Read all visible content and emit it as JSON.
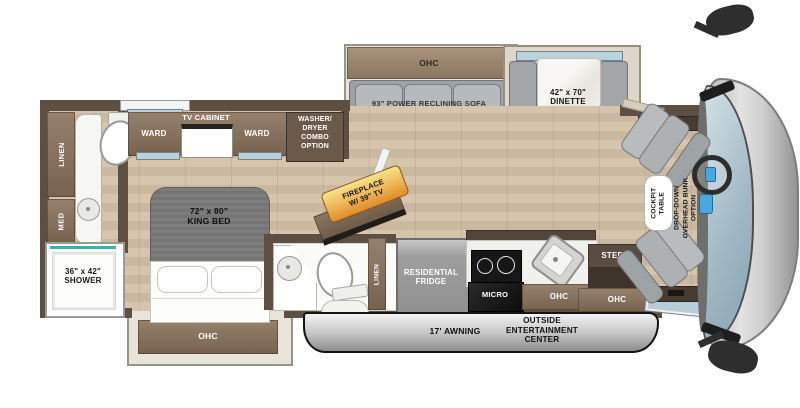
{
  "plan_name": "Class A motorhome floorplan",
  "colors": {
    "wall_brown": "#5d4f42",
    "cabinet_brown": "#86715c",
    "floor_tan": "#d2c0a8",
    "furniture_gray": "#aaadaf",
    "accent_teal": "#35b3ab",
    "fireplace_label_yellow": "#f5d469",
    "fireplace_label_orange": "#e18d2a",
    "windshield_blue": "#a9c0cc",
    "awning_gray": "#c6c6c6"
  },
  "rear_bath": {
    "linen": "LINEN",
    "med": "MED",
    "shower": "36\" x 42\"\nSHOWER"
  },
  "bedroom": {
    "ward_left": "WARD",
    "tv_cabinet": "TV CABINET",
    "ward_right": "WARD",
    "washer_dryer": "WASHER/\nDRYER\nCOMBO\nOPTION",
    "king_bed": "72\" x 80\"\nKING BED",
    "ohc": "OHC"
  },
  "living": {
    "ohc": "OHC",
    "sofa": "93\" POWER RECLINING SOFA",
    "dinette": "42\" x 70\"\nDINETTE",
    "fireplace": "FIREPLACE\nW/ 39\" TV"
  },
  "mid_bath": {
    "med": "MED",
    "linen": "LINEN"
  },
  "kitchen": {
    "fridge": "RESIDENTIAL\nFRIDGE",
    "micro": "MICRO",
    "ohc": "OHC"
  },
  "entry": {
    "steps": "STEPS",
    "ohc": "OHC"
  },
  "exterior": {
    "awning": "17' AWNING",
    "entertainment": "OUTSIDE\nENTERTAINMENT\nCENTER"
  },
  "cockpit": {
    "table": "COCKPIT\nTABLE",
    "bunk": "DROP-DOWN\nOVERHEAD BUNK\nOPTION"
  }
}
